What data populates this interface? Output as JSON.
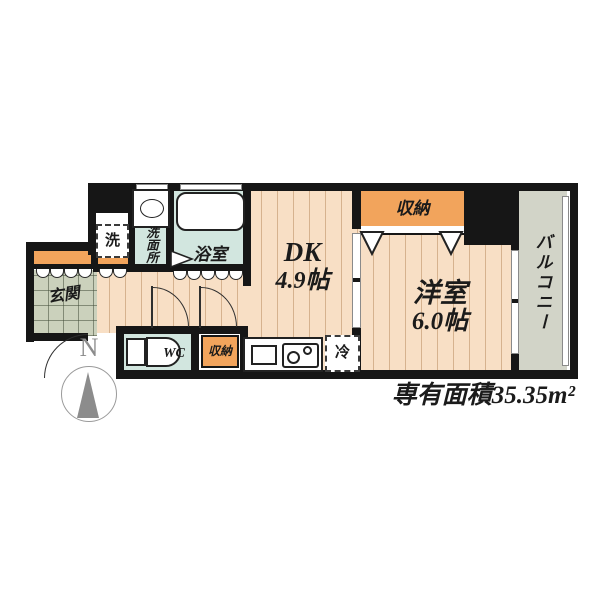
{
  "plan": {
    "rooms": {
      "dk": {
        "name": "DK",
        "size": "4.9帖"
      },
      "western": {
        "name": "洋室",
        "size": "6.0帖"
      },
      "bath": {
        "label": "浴室"
      },
      "washroom": {
        "label": "洗面所"
      },
      "wc": {
        "label": "WC"
      },
      "entrance": {
        "label": "玄関"
      },
      "balcony": {
        "label": "バルコニー"
      },
      "closet_top": {
        "label": "収納"
      },
      "closet_hall": {
        "label": "収納"
      },
      "washer": {
        "label": "洗"
      },
      "fridge": {
        "label": "冷"
      }
    },
    "compass": {
      "north": "N"
    },
    "area_note": "専有面積35.35m²",
    "colors": {
      "wall": "#161616",
      "wood_floor": "#f8dfc5",
      "closet_orange": "#f2a45c",
      "wet_room_floor": "#d2e6df",
      "entrance_tile": "#cbd1bc",
      "balcony": "#d2d4c8",
      "compass_gray": "#8c8c8c"
    }
  }
}
